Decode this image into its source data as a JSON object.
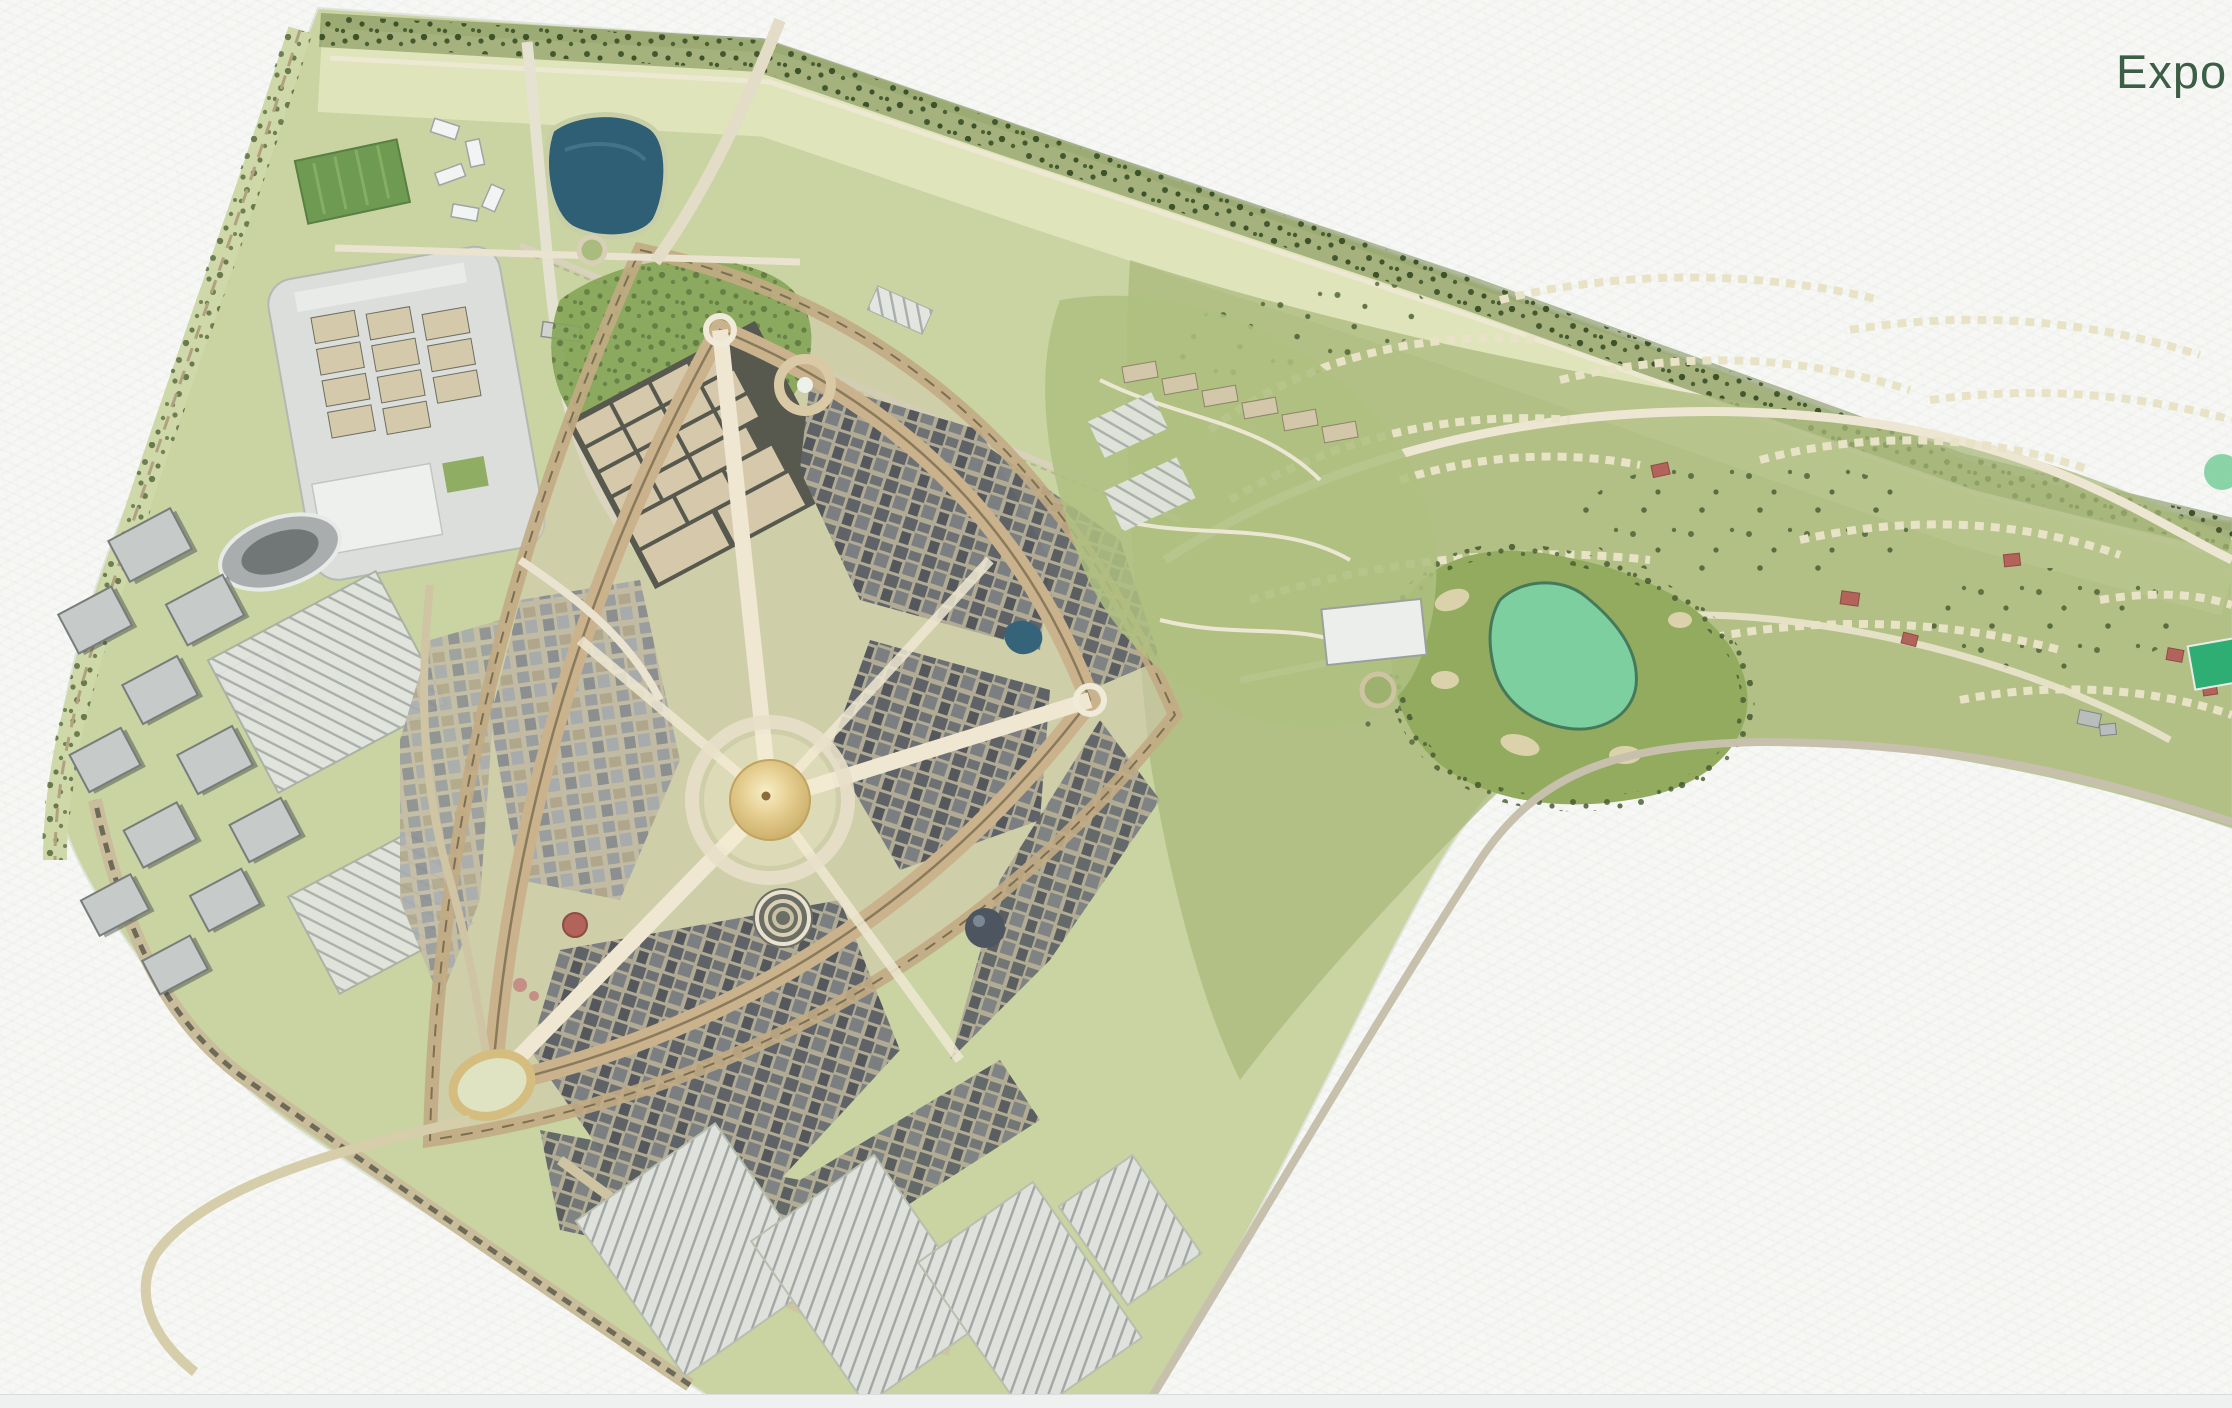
{
  "header": {
    "title_visible": "Expo",
    "title_color": "#3c5e46"
  },
  "map": {
    "name": "expo-dubai-site-masterplan",
    "kind": "illustrated aerial masterplan",
    "features": [
      {
        "id": "site-boundary",
        "kind": "site outline"
      },
      {
        "id": "perimeter-tree-band",
        "kind": "tree belt along top edge"
      },
      {
        "id": "left-boulevard",
        "kind": "tree-lined boulevard on west edge"
      },
      {
        "id": "lake",
        "kind": "water body"
      },
      {
        "id": "sports-fields",
        "kind": "green playing fields"
      },
      {
        "id": "sculpture-cluster",
        "kind": "white angular structures"
      },
      {
        "id": "exhibition-centre",
        "kind": "large hall compound"
      },
      {
        "id": "oval-hall",
        "kind": "oval venue"
      },
      {
        "id": "metro-line",
        "kind": "transit ribbon with station"
      },
      {
        "id": "office-cluster",
        "kind": "gray office blocks"
      },
      {
        "id": "west-parking",
        "kind": "striped parking grid"
      },
      {
        "id": "outer-ring-road",
        "kind": "outer loop road"
      },
      {
        "id": "loop-road",
        "kind": "main expo loop"
      },
      {
        "id": "radial-avenues",
        "kind": "avenues from central plaza"
      },
      {
        "id": "district-blocks",
        "kind": "dense building districts"
      },
      {
        "id": "al-wasl-dome",
        "kind": "central golden dome"
      },
      {
        "id": "garden-ring",
        "kind": "ring garden structure"
      },
      {
        "id": "north-gate",
        "kind": "entry ring"
      },
      {
        "id": "east-gate",
        "kind": "entry ring"
      },
      {
        "id": "southwest-gate",
        "kind": "oval entry ring"
      },
      {
        "id": "amphitheater",
        "kind": "concentric stage rings"
      },
      {
        "id": "dark-pavilion",
        "kind": "dark spherical pavilion"
      },
      {
        "id": "red-dome-pavilion",
        "kind": "red dome"
      },
      {
        "id": "small-pond",
        "kind": "small water feature"
      },
      {
        "id": "inner-parks",
        "kind": "interior green patches"
      },
      {
        "id": "south-parking-lots",
        "kind": "striped parking fields"
      },
      {
        "id": "waist-park",
        "kind": "parkland with winding paths"
      },
      {
        "id": "park-roundabout",
        "kind": "green roundabout"
      },
      {
        "id": "golf-course",
        "kind": "fairway with bunkers"
      },
      {
        "id": "golf-green",
        "kind": "mint putting green"
      },
      {
        "id": "residential-rows",
        "kind": "curved villa rows"
      },
      {
        "id": "red-roof-villas",
        "kind": "red roofed buildings"
      },
      {
        "id": "sports-pitch",
        "kind": "bright green pitch"
      },
      {
        "id": "right-arm-roads",
        "kind": "winding spine roads"
      },
      {
        "id": "bay-edge-road",
        "kind": "road along concave boundary"
      },
      {
        "id": "southwest-exit-road",
        "kind": "exit road to south-west"
      },
      {
        "id": "north-entry-road",
        "kind": "road entering from top"
      },
      {
        "id": "rail-line",
        "kind": "straight rail corridor"
      },
      {
        "id": "depot",
        "kind": "striped depot"
      }
    ]
  },
  "colors": {
    "paper": "#f7f8f5",
    "heading_green": "#3c5e46",
    "site_base": "#c9d4a2",
    "site_pale": "#e0e5bd",
    "site_olive": "#a9ba7c",
    "tree_dark": "#44582f",
    "park_green": "#84a557",
    "lake_blue": "#2e5f74",
    "pond_blue": "#35647a",
    "golf_green": "#7ecf9f",
    "fairway": "#93ab5f",
    "pitch_green": "#2fae74",
    "dome_gold": "#d9c07c",
    "plaza_beige": "#d2c9ae",
    "road_cream": "#ece6d2",
    "loop_tan": "#c9b28c",
    "hall_tan": "#d5c9ac",
    "block_gray": "#5f6367",
    "building_gray": "#c6cac9",
    "white_building": "#eef0ee",
    "parking_gray": "#e3e5e1",
    "red_roof": "#b2635a",
    "rail_brown": "#6d6a57",
    "footer_strip": "#eef1f0"
  },
  "footer": {
    "strip_color": "#eef1f0"
  }
}
